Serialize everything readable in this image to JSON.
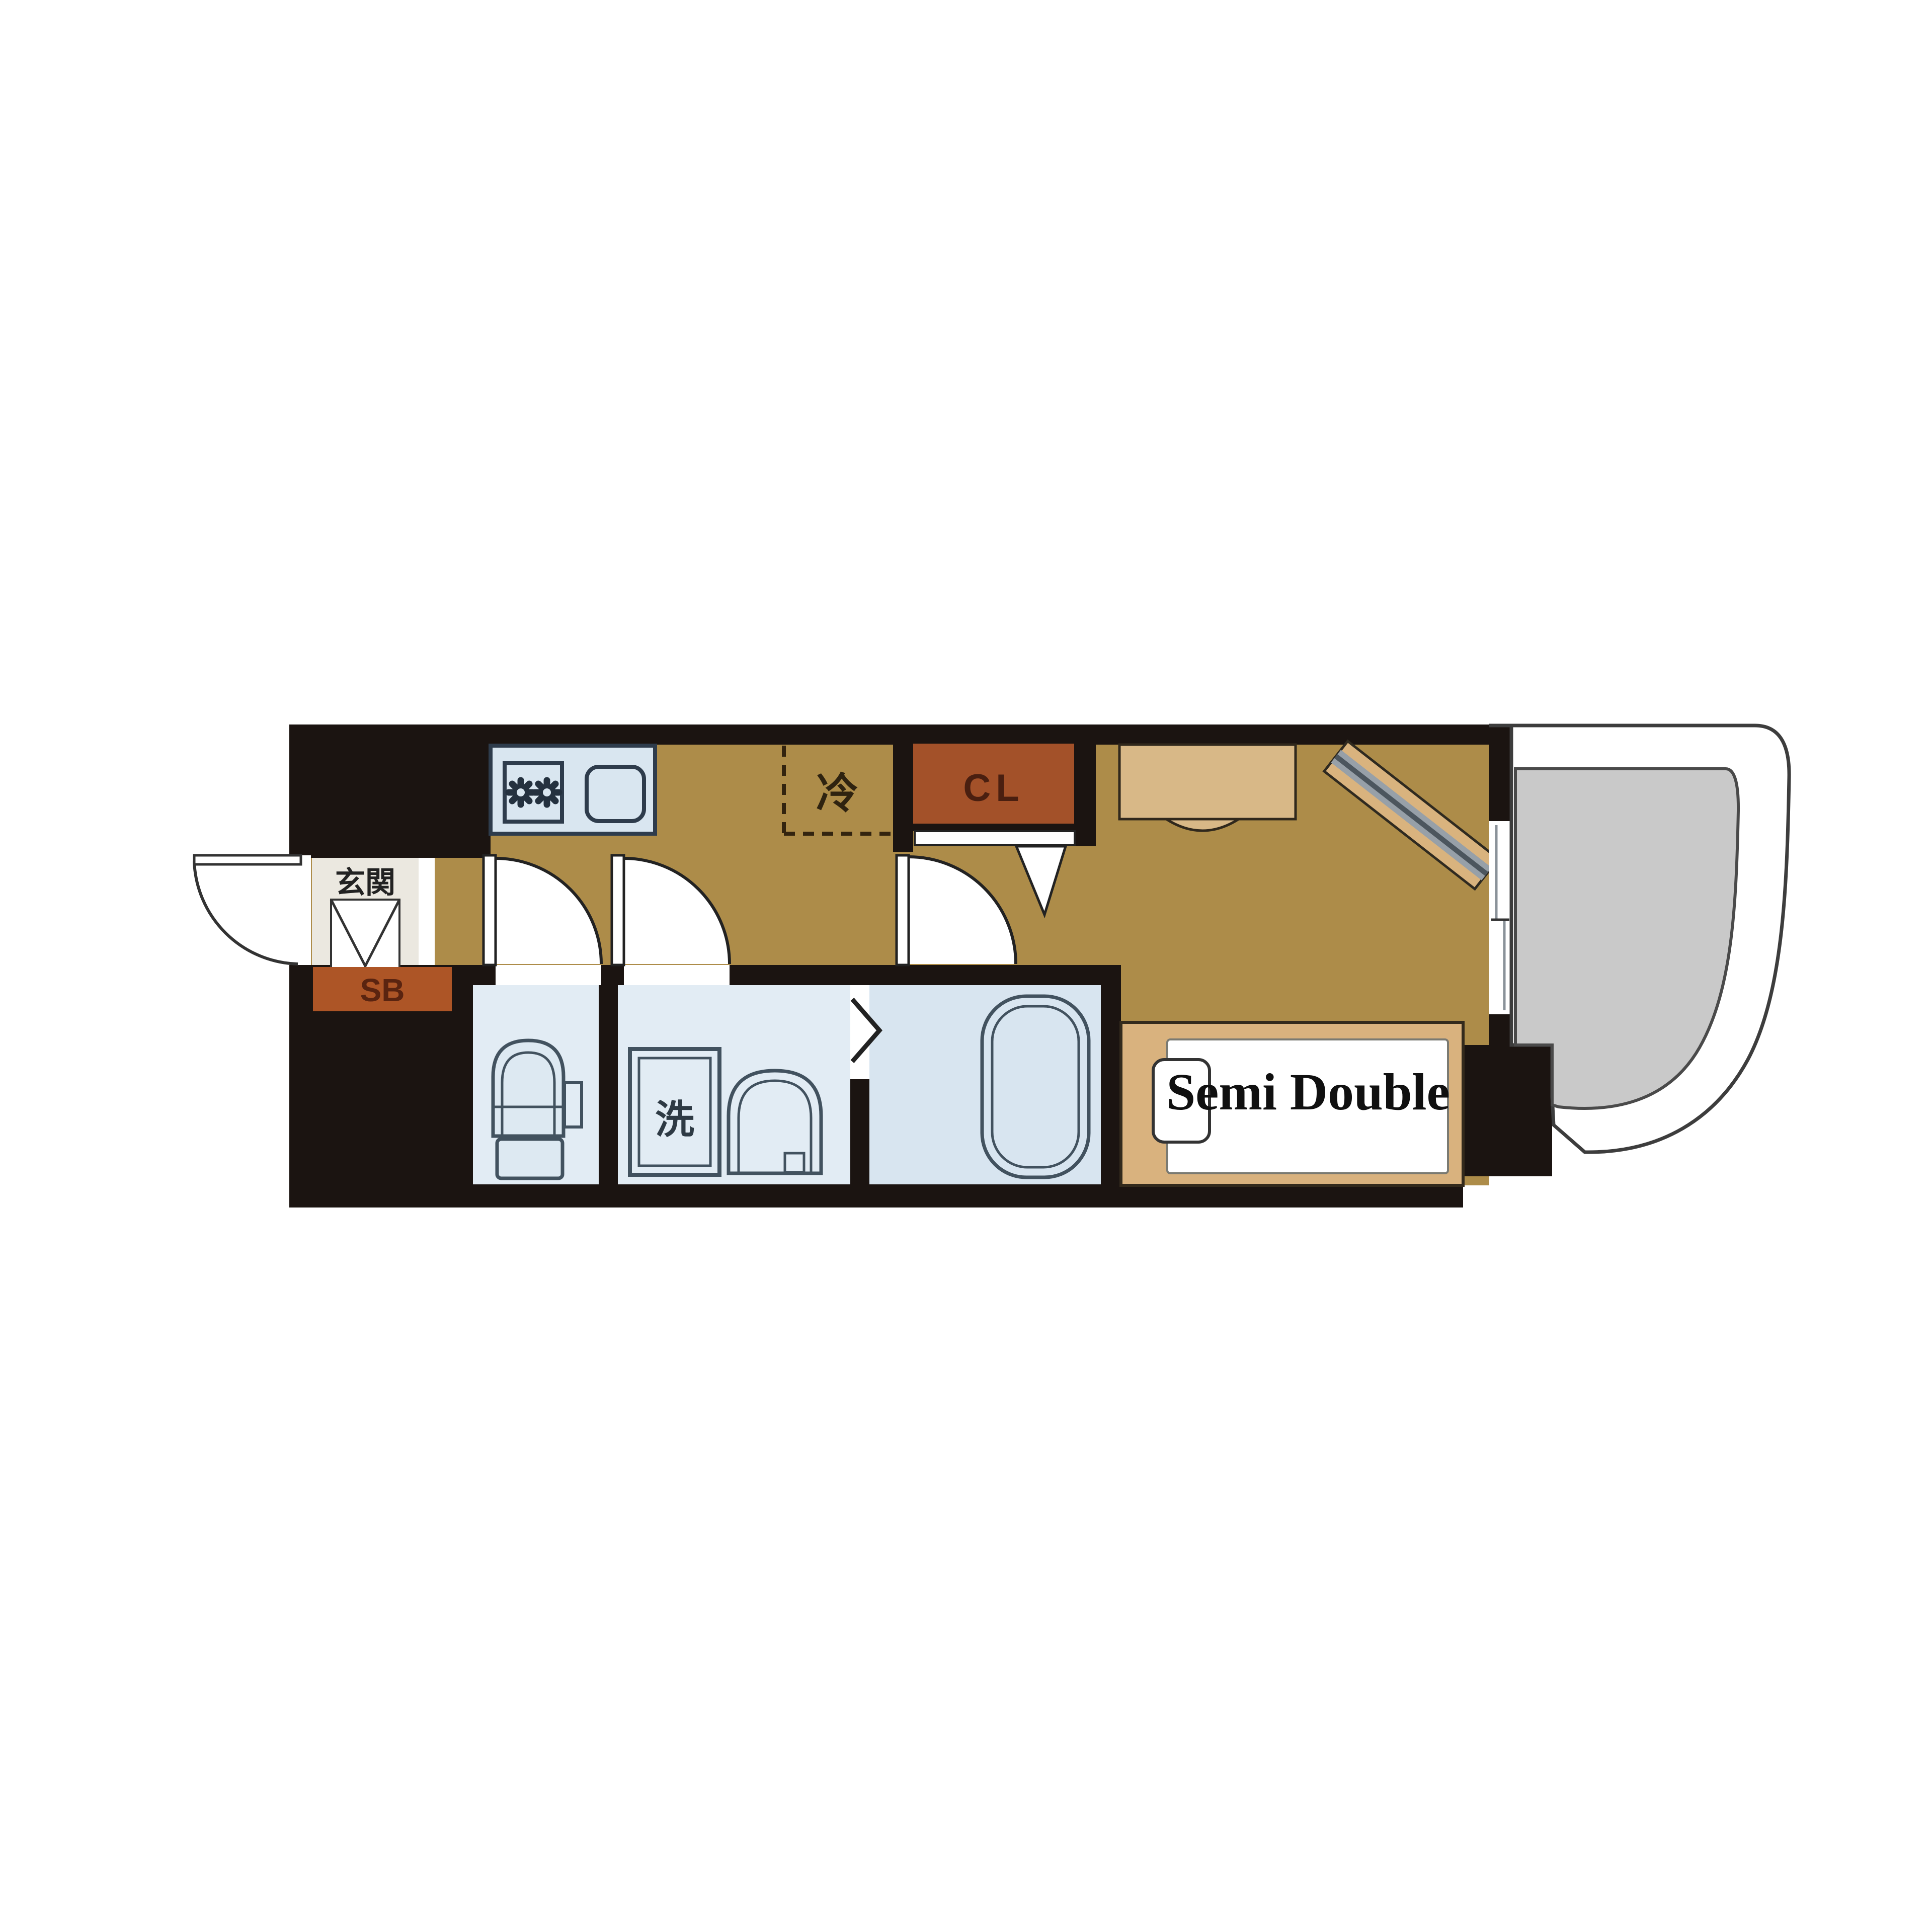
{
  "floorplan": {
    "labels": {
      "entrance": "玄関",
      "shoe_box": "SB",
      "closet": "CL",
      "refrigerator": "冷",
      "washing_machine": "洗",
      "bed": "Semi Double"
    },
    "colors": {
      "wall": "#1b1411",
      "wood_floor": "#ad8c49",
      "entrance_floor": "#ebe8e0",
      "wet_floor": "#e2ecf4",
      "bath_floor": "#d8e5f0",
      "fixture_outline": "#42525f",
      "closet_rust": "#a35129",
      "shoe_box_rust": "#ad5526",
      "furniture_wood": "#d9b27e",
      "desk_wood": "#d8b887",
      "balcony_gray": "#c9c9c9",
      "mattress_white": "#ffffff"
    }
  }
}
